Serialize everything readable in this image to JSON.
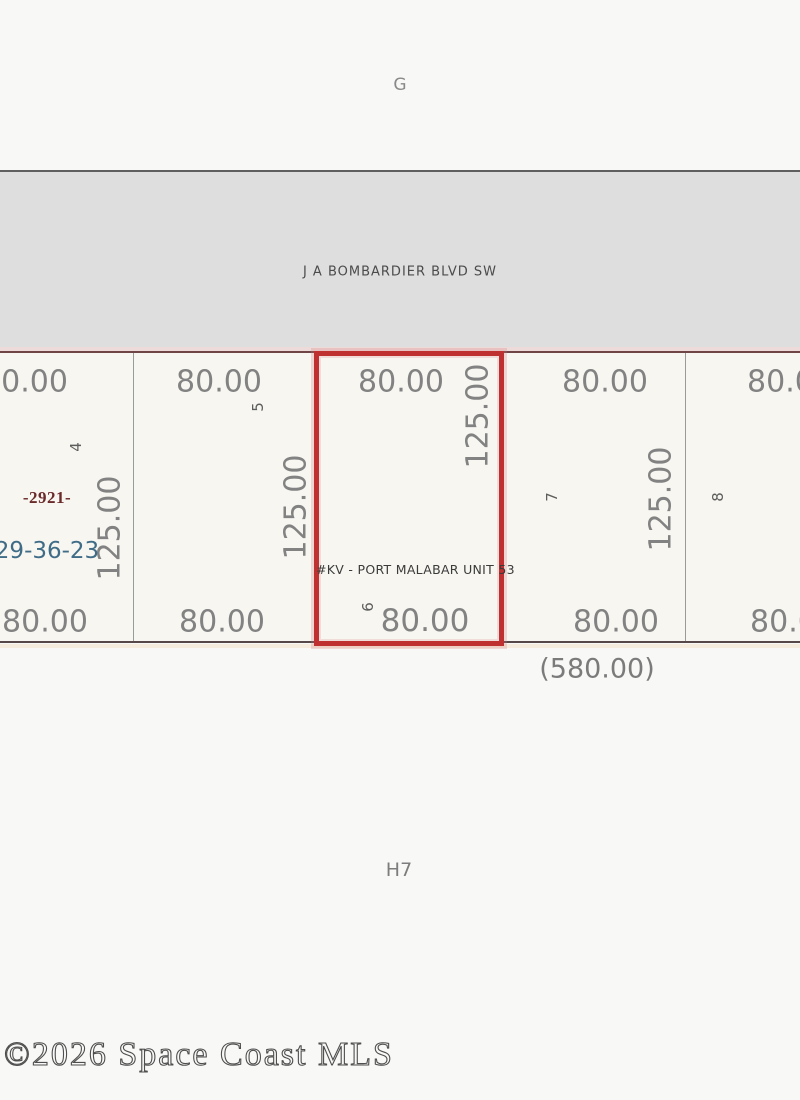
{
  "grid": {
    "top_label": "G",
    "bottom_label": "H7"
  },
  "road": {
    "name": "J A BOMBARDIER BLVD SW"
  },
  "block": {
    "plat_number": "-2921-",
    "section_township_range": "29-36-23",
    "total_frontage": "(580.00)",
    "subdivision_label": "#KV - PORT MALABAR UNIT 53"
  },
  "lots": [
    {
      "number": "4",
      "front": "80.00",
      "rear": "80.00",
      "depth": "125.00",
      "highlighted": false
    },
    {
      "number": "5",
      "front": "80.00",
      "rear": "80.00",
      "depth": "125.00",
      "highlighted": false
    },
    {
      "number": "6",
      "front": "80.00",
      "rear": "80.00",
      "depth": "125.00",
      "highlighted": true
    },
    {
      "number": "7",
      "front": "80.00",
      "rear": "80.00",
      "depth": "125.00",
      "highlighted": false
    },
    {
      "number": "8",
      "front": "80.00",
      "rear": "80.00",
      "highlighted": false
    }
  ],
  "watermark": "©2026 Space Coast MLS",
  "colors": {
    "highlight_red": "#bf3030",
    "road_fill": "#dedede",
    "dimension_text": "#828282",
    "plat_number_red": "#6b2a2a",
    "section_blue": "#3f6c87",
    "boundary_brown": "#6f4545"
  }
}
